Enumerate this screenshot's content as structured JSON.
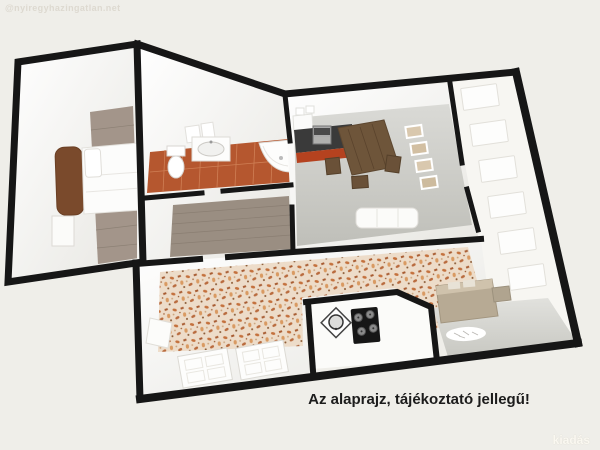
{
  "page": {
    "background_color": "#efeee9",
    "watermark_top_left": "@nyiregyhazingatlan.net",
    "caption": "Az alaprajz, tájékoztató jellegű!",
    "watermark_bottom_right": "kiadás"
  },
  "floorplan": {
    "type": "3d-floor-plan",
    "wall_color": "#161616",
    "floors": {
      "bedroom_wood": "#a3958a",
      "bathroom_tile": "#b5572f",
      "hallway_wood": "#9a8e82",
      "kitchen_gray": "#c9c9c4",
      "living_pattern_base": "#eddcc9",
      "living_pattern_accent": "#c4713d",
      "utility_gray": "#d2d2cd",
      "kitchen_cabinet_red": "#b5421f",
      "counter_dark": "#3a3a3a",
      "dining_wood": "#6e553a"
    },
    "furniture_icons": [
      "bed-icon",
      "nightstand-icon",
      "towel-icon",
      "toilet-icon",
      "sink-vanity-icon",
      "corner-shower-icon",
      "kitchen-counter-icon",
      "stove-icon",
      "dining-table-icon",
      "chair-icon",
      "picture-frame-icon",
      "sofa-icon",
      "door-panel-icon",
      "window-icon",
      "gas-hob-icon",
      "washing-machine-icon",
      "cabinet-icon",
      "vent-icon",
      "wardrobe-panel-icon"
    ]
  }
}
